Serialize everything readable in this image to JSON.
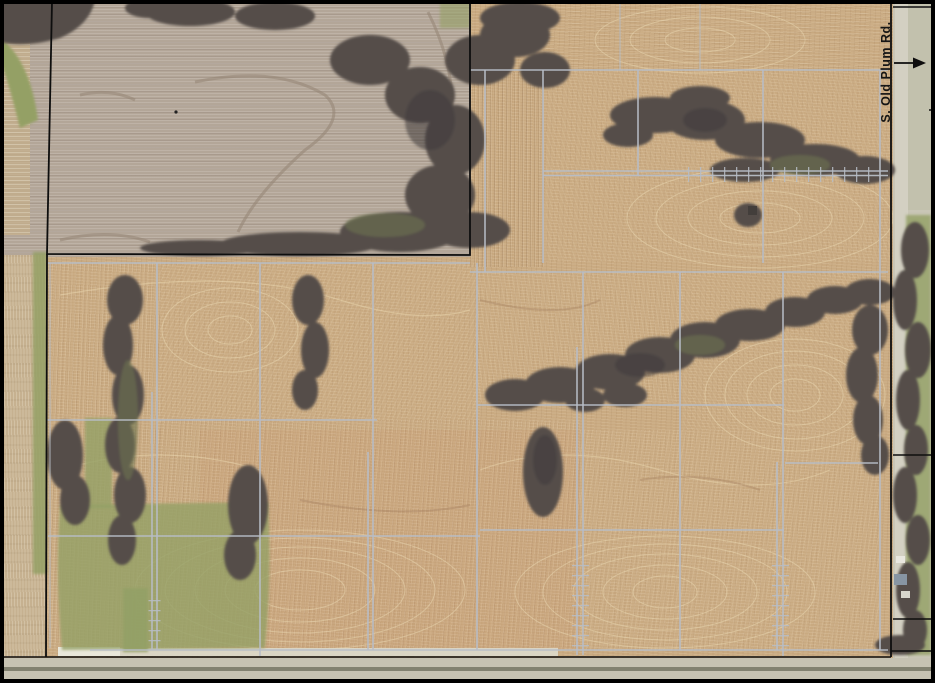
{
  "map": {
    "road_label": "S. Old Plum Rd."
  },
  "colors": {
    "boundary_black": "#0e0e0e",
    "tile_line_gray": "#b7bdc6",
    "field_tan": "#c9aa81",
    "field_gray": "#b3a698",
    "vegetation_dark": "#554d49",
    "grass_green": "#94a065",
    "road_surface": "#c6c2b2"
  }
}
